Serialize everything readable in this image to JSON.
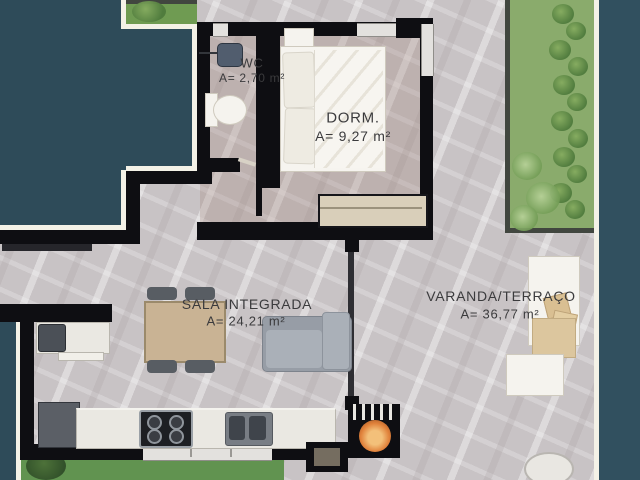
{
  "plan": {
    "rooms": [
      {
        "name": "WC",
        "area": "A= 2,70 m²"
      },
      {
        "name": "DORM.",
        "area": "A= 9,27 m²"
      },
      {
        "name": "SALA INTEGRADA",
        "area": "A= 24,21 m²"
      },
      {
        "name": "VARANDA/TERRAÇO",
        "area": "A= 36,77 m²"
      }
    ],
    "furniture": [
      "toilet",
      "washbasin",
      "bed",
      "wardrobe",
      "dining-table",
      "chairs",
      "sofa",
      "console",
      "kitchen-counter",
      "stove",
      "sink",
      "fridge",
      "barbecue-grill",
      "lounge-chair",
      "side-table",
      "statue"
    ],
    "colors": {
      "outside": "#2e4b59",
      "wall": "#0e0e12",
      "outline": "#f4f2e7",
      "floor": "#c8c3c5",
      "floor_warm_tint": "#957464",
      "garden": "#8aab6c",
      "lawn": "#619350",
      "wood": "#c9b394",
      "counter": "#eae8e2",
      "sofa": "#aab0b8",
      "fire": "#e0813a",
      "text": "#3b3b3d"
    }
  }
}
